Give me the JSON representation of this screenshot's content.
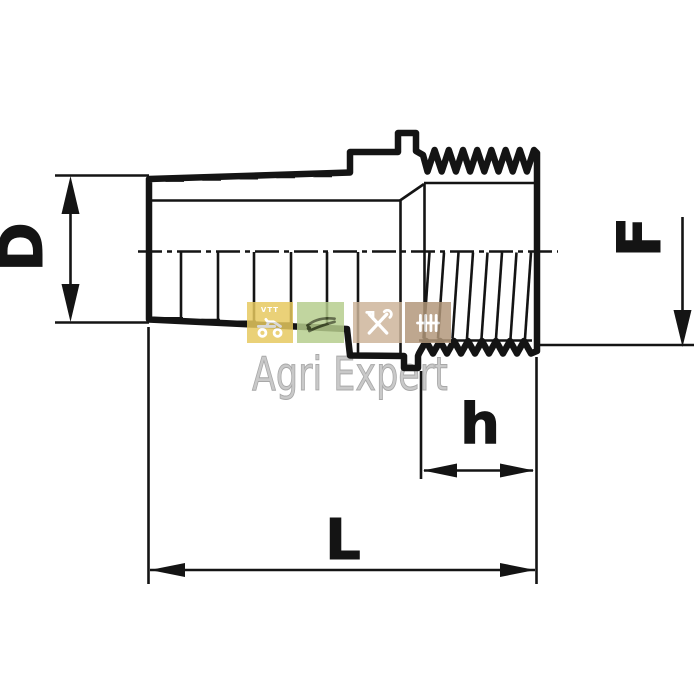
{
  "drawing": {
    "background": "#ffffff",
    "line_color": "#141414",
    "labels": {
      "D": "D",
      "F": "F",
      "h": "h",
      "L": "L"
    }
  },
  "watermark": {
    "text": "Agri Expert",
    "text_color": "#c9c9c9",
    "squares": [
      {
        "icon": "quad-bike-icon",
        "label": "VTT",
        "color": "#e7c95f",
        "icon_color": "#ffffff"
      },
      {
        "icon": "pruning-shears-icon",
        "label": "",
        "color": "#b6cd8d",
        "icon_color": "#46522c"
      },
      {
        "icon": "crossed-tools-icon",
        "label": "",
        "color": "#cdb59a",
        "icon_color": "#ffffff"
      },
      {
        "icon": "rake-icon",
        "label": "",
        "color": "#b2977a",
        "icon_color": "#ffffff"
      }
    ]
  }
}
